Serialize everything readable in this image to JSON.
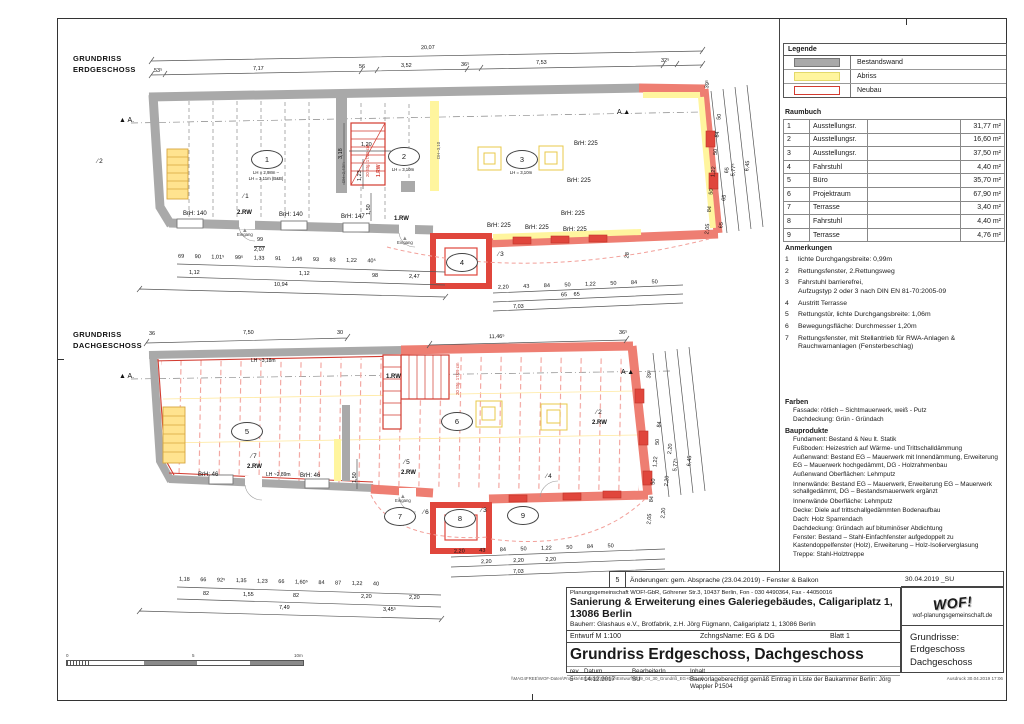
{
  "legend": {
    "title": "Legende",
    "items": [
      {
        "label": "Bestandswand",
        "type": "bestand",
        "color": "#a9a9a9"
      },
      {
        "label": "Abriss",
        "type": "abriss",
        "color": "#fff59e"
      },
      {
        "label": "Neubau",
        "type": "neubau",
        "color": "#d23b30"
      }
    ]
  },
  "raumbuch": {
    "title": "Raumbuch",
    "rows": [
      {
        "nr": "1",
        "name": "Ausstellungsr.",
        "area": "31,77 m²"
      },
      {
        "nr": "2",
        "name": "Ausstellungsr.",
        "area": "16,60 m²"
      },
      {
        "nr": "3",
        "name": "Ausstellungsr.",
        "area": "37,50 m²"
      },
      {
        "nr": "4",
        "name": "Fahrstuhl",
        "area": "4,40 m²"
      },
      {
        "nr": "5",
        "name": "Büro",
        "area": "35,70 m²"
      },
      {
        "nr": "6",
        "name": "Projektraum",
        "area": "67,90 m²"
      },
      {
        "nr": "7",
        "name": "Terrasse",
        "area": "3,40 m²"
      },
      {
        "nr": "8",
        "name": "Fahrstuhl",
        "area": "4,40 m²"
      },
      {
        "nr": "9",
        "name": "Terrasse",
        "area": "4,76 m²"
      }
    ]
  },
  "anmerkungen": {
    "title": "Anmerkungen",
    "items": [
      {
        "nr": "1",
        "text": "lichte Durchgangsbreite: 0,99m"
      },
      {
        "nr": "2",
        "text": "Rettungsfenster, 2.Rettungsweg"
      },
      {
        "nr": "3",
        "text": "Fahrstuhl barrierefrei,\nAufzugstyp 2 oder 3 nach DIN EN 81-70:2005-09"
      },
      {
        "nr": "4",
        "text": "Austritt Terrasse"
      },
      {
        "nr": "5",
        "text": "Rettungstür, lichte Durchgangsbreite: 1,06m"
      },
      {
        "nr": "6",
        "text": "Bewegungsfläche: Durchmesser 1,20m"
      },
      {
        "nr": "7",
        "text": "Rettungsfenster, mit Stellantrieb für RWA-Anlagen &\nRauchwarnanlagen (Fensterbeschlag)"
      }
    ]
  },
  "farben": {
    "title": "Farben",
    "lines": [
      "Fassade: rötlich – Sichtmauerwerk, weiß - Putz",
      "Dachdeckung: Grün - Gründach"
    ]
  },
  "bauprodukte": {
    "title": "Bauprodukte",
    "lines": [
      "Fundament: Bestand & Neu lt. Statik",
      "Fußboden: Heizestrich auf Wärme- und Trittschalldämmung",
      "Außenwand: Bestand EG – Mauerwerk mit Innendämmung, Erweiterung EG – Mauerwerk hochgedämmt, DG - Holzrahmenbau",
      "Außenwand Oberflächen: Lehmputz",
      "Innenwände: Bestand EG – Mauerwerk, Erweiterung EG – Mauerwerk schallgedämmt, DG – Bestandsmauerwerk ergänzt",
      "Innenwände Oberfläche: Lehmputz",
      "Decke: Diele auf trittschallgedämmten Bodenaufbau",
      "Dach: Holz Sparrendach",
      "Dachdeckung: Gründach auf bituminöser Abdichtung",
      "Fenster: Bestand – Stahl-Einfachfenster aufgedoppelt zu Kastendoppelfenster (Holz), Erweiterung – Holz-Isolierverglasung",
      "Treppe: Stahl-Holztreppe"
    ]
  },
  "titleblock": {
    "rev_nr": "5",
    "rev_text": "Änderungen: gem. Absprache (23.04.2019) - Fenster & Balkon",
    "rev_date": "30.04.2019 _SU",
    "firm": "Planungsgemeinschaft WOF!-GbR, Göhrener Str.3, 10437 Berlin, Fon - 030 4490364, Fax - 44050016",
    "project": "Sanierung & Erweiterung eines Galeriegebäudes, Caligariplatz 1, 13086 Berlin",
    "bauherr": "Bauherr:   Glashaus e.V., Brotfabrik, z.H. Jörg Fügmann, Caligariplatz 1, 13086 Berlin",
    "entwurf": "Entwurf M 1:100",
    "zchngs": "ZchngsName:  EG & DG",
    "blatt": "Blatt  1",
    "main_title": "Grundriss Erdgeschoss, Dachgeschoss",
    "rev_h1": "rev",
    "rev_h2": "Datum",
    "rev_h3": "BearbeiterIn",
    "rev_h4": "Inhalt",
    "rev_r1": "5",
    "rev_r2": "14.12.2017",
    "rev_r3": "SU",
    "rev_r4": "Bauvorlageberechtigt gemäß Eintrag in Liste der Baukammer Berlin: Jörg Wappler P1504",
    "logo": "WOF!",
    "website": "wof-planungsgemeinschaft.de",
    "sheet_line1": "Grundrisse:",
    "sheet_line2": "Erdgeschoss",
    "sheet_line3": "Dachgeschoss",
    "file_path": "\\\\MAG4FREE\\WOF-Daten\\Projekte\\Brotfabrik\\Remise\\Entwurf\\2019_04_30_Grundriß_EG+DG.vsd",
    "print_note": "Ausdruck 30.04.2019 17:06"
  },
  "scalebar": {
    "s0": "0",
    "s5": "5",
    "s10": "10m"
  },
  "plans": {
    "eg": {
      "title1": "GRUNDRISS",
      "title2": "ERDGESCHOSS",
      "marker_a": "A",
      "rooms": {
        "r1": "1",
        "r2": "2",
        "r3": "3",
        "r4": "4"
      },
      "room_sub": {
        "r1a": "LH = 2,98m –",
        "r1b": "LH = 3,11m (B&B)",
        "r2": "LH = 3,10m",
        "r3": "LH = 3,10m"
      },
      "notes": {
        "n1": "1",
        "n2": "2",
        "n3": "3"
      },
      "labels": {
        "rw2": "2.RW",
        "rw1": "1.RW",
        "eingang": "Eingang",
        "brh140": "BrH: 140",
        "brh147": "BrH: 147",
        "brh225": "BrH: 225",
        "stair": "20 Stg. 17/29 cm",
        "dh243": "DH~2,43m",
        "dh310": "DH~3,10",
        "door_w": "99",
        "door_h": "2,07"
      },
      "dims": {
        "total_top": "20,07",
        "top": [
          "53⁵",
          "7,17",
          "56",
          "3,52",
          "36⁵",
          "7,53",
          "32⁵"
        ],
        "bottom1": [
          "69",
          "90",
          "1,01⁵",
          "99⁵",
          "1,33",
          "91",
          "1,46",
          "93",
          "83",
          "1,22",
          "40⁵"
        ],
        "bottom2": [
          "1,12",
          "1,12",
          "98",
          "2,47"
        ],
        "total_bottom": "10,94",
        "inner_120": "1,20",
        "inner_123": "1,23",
        "inner_150": "1,50",
        "inner_318": "3,18",
        "right1": [
          "2,05",
          "84",
          "50",
          "1,22",
          "50",
          "84",
          "50"
        ],
        "right2": [
          "65",
          "65",
          "65"
        ],
        "right_total1": "5,77⁵",
        "right_total2": "6,45",
        "right_end_top": "39⁵",
        "right_end_bot": "28",
        "sub1": [
          "2,20",
          "43",
          "84",
          "50",
          "1,22",
          "50",
          "84",
          "50"
        ],
        "sub2": [
          "65",
          "65"
        ],
        "sub_total": "7,03"
      }
    },
    "dg": {
      "title1": "GRUNDRISS",
      "title2": "DACHGESCHOSS",
      "marker_a": "A",
      "rooms": {
        "r5": "5",
        "r6": "6",
        "r7": "7",
        "r8": "8",
        "r9": "9"
      },
      "notes": {
        "n2": "2",
        "n3": "3",
        "n4": "4",
        "n5": "5",
        "n6": "6",
        "n7": "7"
      },
      "labels": {
        "rw1": "1.RW",
        "rw2": "2.RW",
        "eingang": "Eingang",
        "brh46": "BrH: 46",
        "lh318": "LH ~3,18m",
        "lh289": "LH ~2,89m",
        "stair": "20 Stg. 17/29 cm"
      },
      "dims": {
        "top": [
          "36",
          "7,50",
          "30"
        ],
        "top_right": "11,46⁵",
        "top_end": "36⁵",
        "bottom1": [
          "1,18",
          "66",
          "92⁵",
          "1,35",
          "1,23",
          "66",
          "1,60⁵",
          "84",
          "87",
          "1,22",
          "40"
        ],
        "bottom2": [
          "82",
          "1,55",
          "82",
          "2,20",
          "2,20"
        ],
        "total_b1": "7,49",
        "total_b2": "3,45⁵",
        "inner_150": "1,50",
        "right1": [
          "2,05",
          "84",
          "50",
          "1,22",
          "50",
          "84"
        ],
        "right2": [
          "2,20",
          "2,20",
          "2,20"
        ],
        "right_total1": "5,77⁵",
        "right_total2": "6,45",
        "right_end_top": "39⁵",
        "sub1": [
          "2,20",
          "43",
          "84",
          "50",
          "1,22",
          "50",
          "84",
          "50"
        ],
        "sub2": [
          "2,20",
          "2,20",
          "2,20"
        ],
        "sub_total": "7,03"
      }
    }
  }
}
